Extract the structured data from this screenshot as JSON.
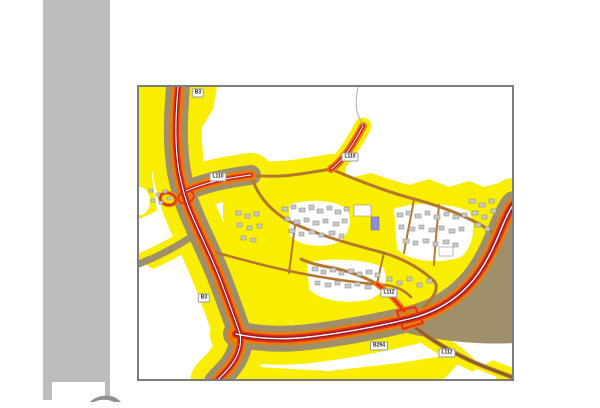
{
  "window": {
    "width": 600,
    "height": 400,
    "background": "#ffffff"
  },
  "sidebar": {
    "color": "#bcbcbc",
    "logo_box_color": "#ffffff"
  },
  "map": {
    "type": "road-noise-map",
    "border_color": "#7c7c7c",
    "background": "#ffffff",
    "colors": {
      "sidebar": "#bcbcbc",
      "border": "#7c7c7c",
      "yellow": "#f9ee00",
      "brown": "#9f8f6a",
      "orange": "#ef7c00",
      "red": "#de3222",
      "darkred": "#9e1b1e",
      "street": "#b5772c",
      "l112core": "#7d5a36",
      "building": "#cacaca",
      "buildingstroke": "#8f8f8f",
      "purple": "#8c8cd9",
      "boundary": "#ababab"
    },
    "road_labels": [
      {
        "id": "b3-north",
        "text": "B3",
        "x": 59,
        "y": 6
      },
      {
        "id": "l110-west",
        "text": "L110",
        "x": 79,
        "y": 90
      },
      {
        "id": "l110-east",
        "text": "L110",
        "x": 211,
        "y": 70
      },
      {
        "id": "l112-mid",
        "text": "L112",
        "x": 250,
        "y": 206
      },
      {
        "id": "b3-south",
        "text": "B3",
        "x": 65,
        "y": 211
      },
      {
        "id": "b294",
        "text": "B294",
        "x": 240,
        "y": 259
      },
      {
        "id": "l112-south",
        "text": "L112",
        "x": 308,
        "y": 266
      }
    ]
  }
}
